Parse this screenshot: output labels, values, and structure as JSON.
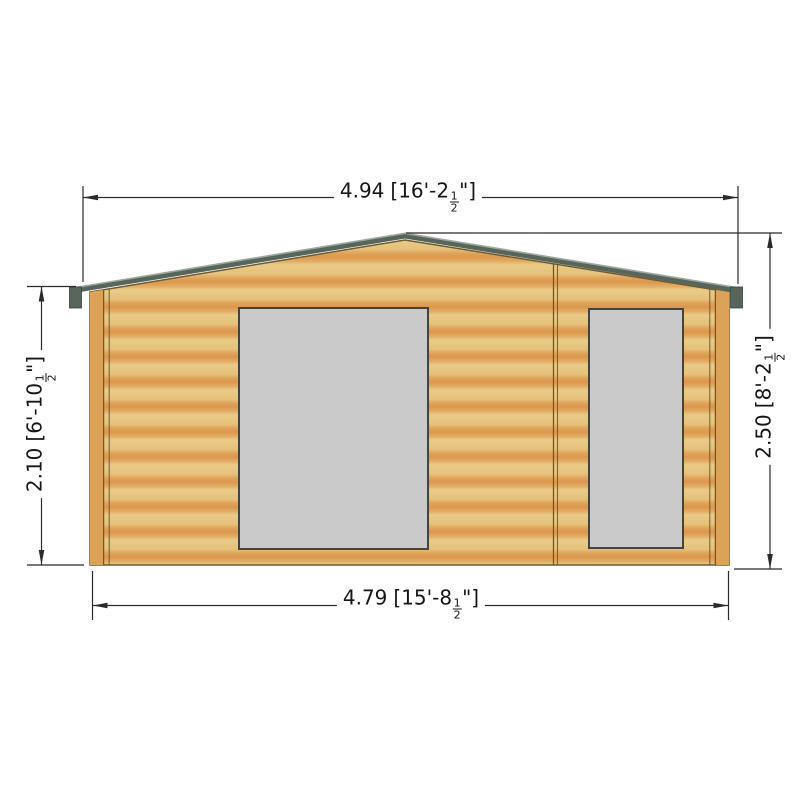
{
  "drawing": {
    "dims": {
      "top": {
        "meters": "4.94",
        "imperial_prefix": "[16'-2",
        "fraction_numerator": "1",
        "fraction_denominator": "2",
        "imperial_suffix": "\"]"
      },
      "bottom": {
        "meters": "4.79",
        "imperial_prefix": "[15'-8",
        "fraction_numerator": "1",
        "fraction_denominator": "2",
        "imperial_suffix": "\"]"
      },
      "left": {
        "meters": "2.10",
        "imperial_prefix": "[6'-10",
        "fraction_numerator": "1",
        "fraction_denominator": "2",
        "imperial_suffix": "\"]"
      },
      "right": {
        "meters": "2.50",
        "imperial_prefix": "[8'-2",
        "fraction_numerator": "1",
        "fraction_denominator": "2",
        "imperial_suffix": "\"]"
      }
    },
    "colors": {
      "wall_light": "#e9cb87",
      "wall_orange": "#dc974c",
      "corner_board": "#dca258",
      "trim_line": "#6e5a2d",
      "fascia": "#57655b",
      "fascia_highlight": "#9fa89e",
      "window_fill": "#c9cac9",
      "window_border": "#45443a",
      "dimension_line": "#2b2b2b"
    }
  }
}
